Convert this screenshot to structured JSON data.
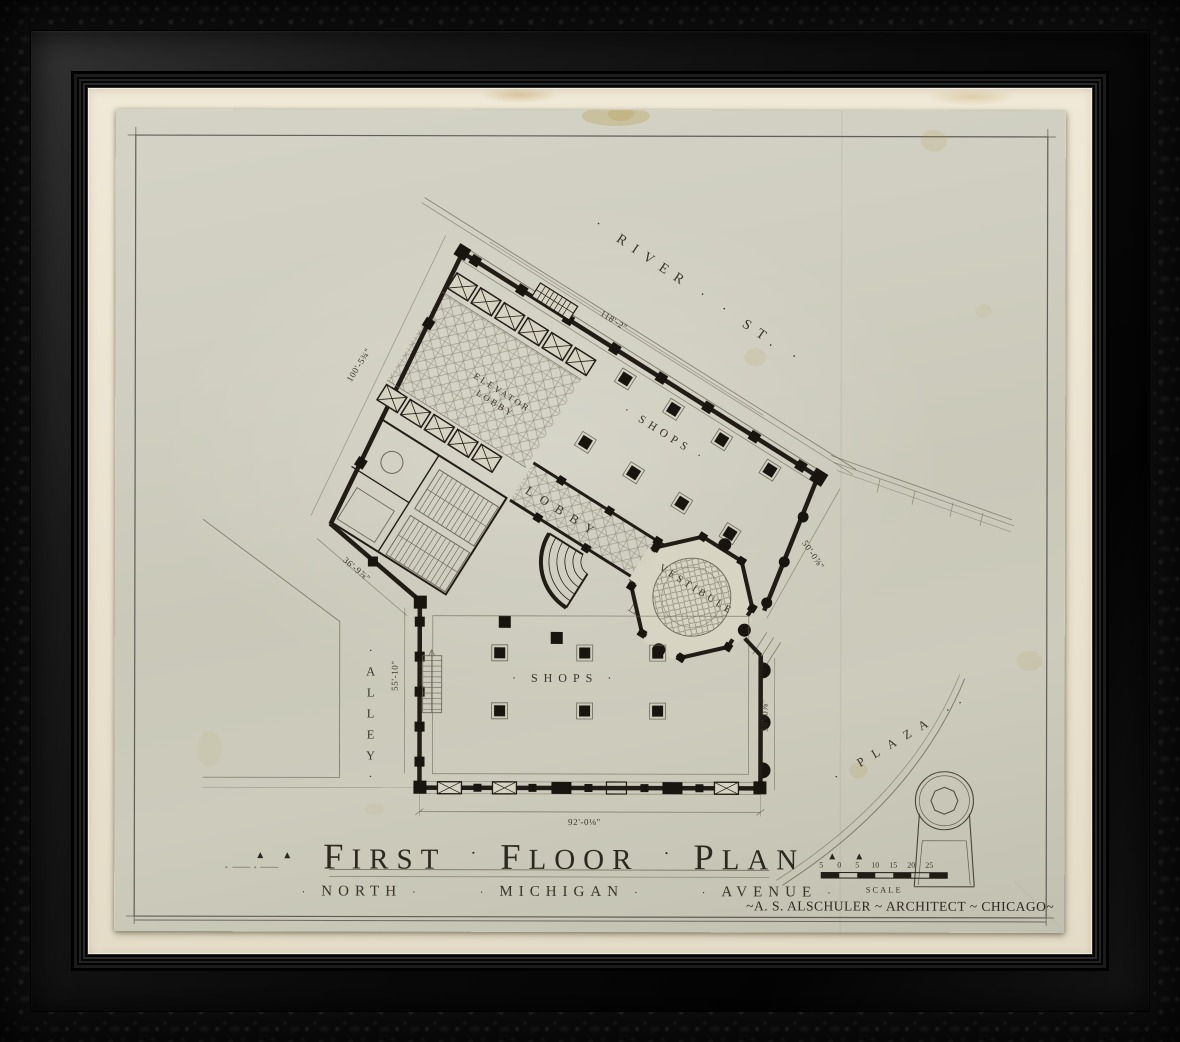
{
  "plan": {
    "streets": {
      "river": "· RIVER ·  · ST. ·",
      "plaza": "· PLAZA ··",
      "alley": "·ALLEY·"
    },
    "rooms": {
      "shops_upper": "· SHOPS ·",
      "shops_lower": "· SHOPS ·",
      "elevator_line1": "ELEVATOR",
      "elevator_line2": "LOBBY",
      "lobby": "LOBBY",
      "vestibule": "VESTIBULE"
    },
    "dimensions": {
      "river_wall": "118'-2\"",
      "west_wall": "100'-5¾\"",
      "southwest_wall": "36'-9⅞\"",
      "alley_side": "55'-10\"",
      "northeast_side": "50'-0⅞\"",
      "east_side": "50'-0⅞\"",
      "south_side": "92'-0⅛\""
    }
  },
  "title_block": {
    "flourish": "▴ ▴",
    "separator": "·",
    "title_words": [
      "First",
      "Floor",
      "Plan"
    ],
    "street_words": [
      "North",
      "Michigan",
      "Avenue"
    ],
    "street_separator": "·",
    "signature": "~A. S. Alschuler ~ Architect ~ Chicago~"
  },
  "scale_bar": {
    "ticks": [
      "5",
      "0",
      "5",
      "10",
      "15",
      "20",
      "25"
    ],
    "label": "Scale"
  },
  "colors": {
    "ink": "#211c15",
    "paper": "#cccbbc",
    "mat": "#eae2cf",
    "frame": "#0e0e0e"
  }
}
